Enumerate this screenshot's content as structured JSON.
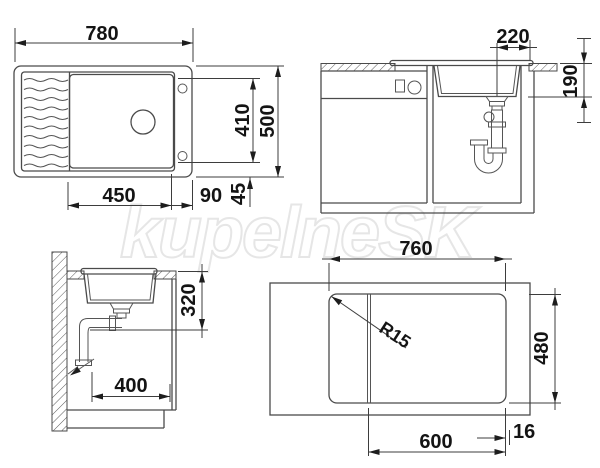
{
  "watermark": "kupelneSK",
  "plan_view": {
    "overall_width": "780",
    "bowl_width": "450",
    "bowl_to_edge": "90",
    "edge_radius": "45",
    "bowl_depth": "410",
    "overall_depth": "500"
  },
  "front_section": {
    "drain_to_edge": "220",
    "bowl_height": "190"
  },
  "side_section": {
    "drain_outlet_height": "320",
    "wall_to_drain": "400"
  },
  "cutout_view": {
    "cutout_width": "760",
    "cutout_depth": "480",
    "corner_radius": "R15",
    "bowl_section_width": "600",
    "edge_margin": "16"
  }
}
